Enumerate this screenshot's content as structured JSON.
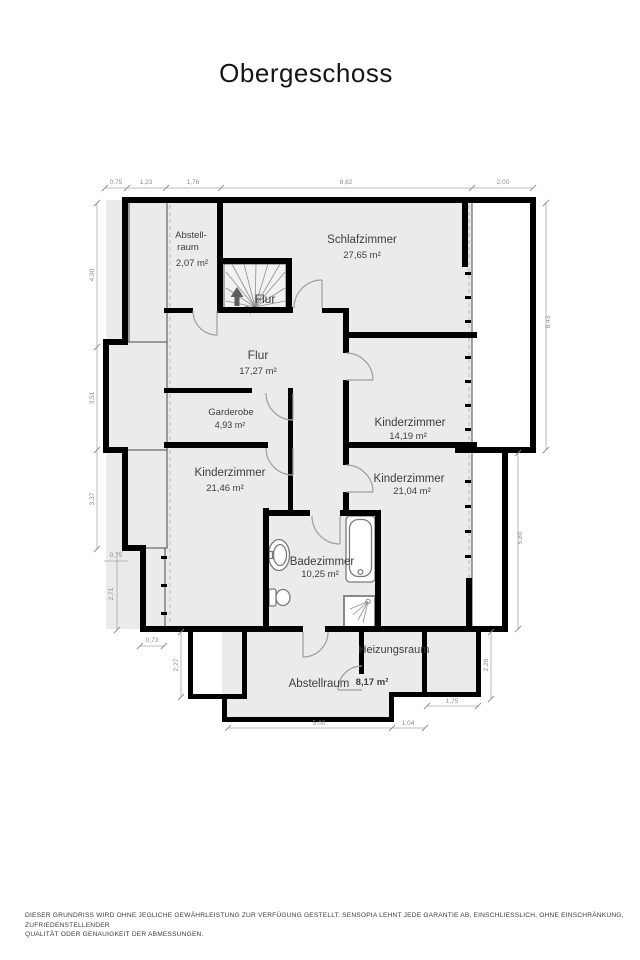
{
  "title": "Obergeschoss",
  "rooms": {
    "abstellraum_top": {
      "name_line1": "Abstell-",
      "name_line2": "raum",
      "area": "2,07 m²"
    },
    "schlafzimmer": {
      "name": "Schlafzimmer",
      "area": "27,65 m²"
    },
    "flur_stairs": {
      "name": "Flur",
      "area_partial": "5,0 m²"
    },
    "flur": {
      "name": "Flur",
      "area": "17,27 m²"
    },
    "garderobe": {
      "name": "Garderobe",
      "area": "4,93 m²"
    },
    "kinderzimmer_east": {
      "name": "Kinderzimmer",
      "area": "14,19 m²"
    },
    "kinderzimmer_west": {
      "name": "Kinderzimmer",
      "area": "21,46 m²"
    },
    "kinderzimmer_south": {
      "name": "Kinderzimmer",
      "area": "21,04 m²"
    },
    "badezimmer": {
      "name": "Badezimmer",
      "area": "10,25 m²"
    },
    "heizungsraum": {
      "name": "Heizungsraum",
      "area": "8,17 m²"
    },
    "abstellraum_bottom": {
      "name": "Abstellraum"
    }
  },
  "dimensions": {
    "top": [
      "0,75",
      "1,23",
      "1,76",
      "8,82",
      "2,00"
    ],
    "left": [
      "4,90",
      "3,51",
      "3,37",
      "0,75",
      "2,71",
      "0,73",
      "2,27"
    ],
    "right": [
      "8,43",
      "5,80",
      "2,28",
      "1,75"
    ],
    "bottom": [
      "5,00",
      "1,04"
    ]
  },
  "footer": {
    "line1": "DIESER GRUNDRISS WIRD OHNE JEGLICHE GEWÄHRLEISTUNG ZUR VERFÜGUNG GESTELLT. SENSOPIA LEHNT JEDE GARANTIE AB, EINSCHLIESSLICH, OHNE EINSCHRÄNKUNG, ZUFRIEDENSTELLENDER",
    "line2": "QUALITÄT ODER GENAUIGKEIT DER ABMESSUNGEN."
  },
  "colors": {
    "wall": "#000000",
    "room_fill": "#ebebeb",
    "hatch_line": "#b3b3b3",
    "dimension_text": "#8c8c8c",
    "label_text": "#3d3d3d"
  }
}
